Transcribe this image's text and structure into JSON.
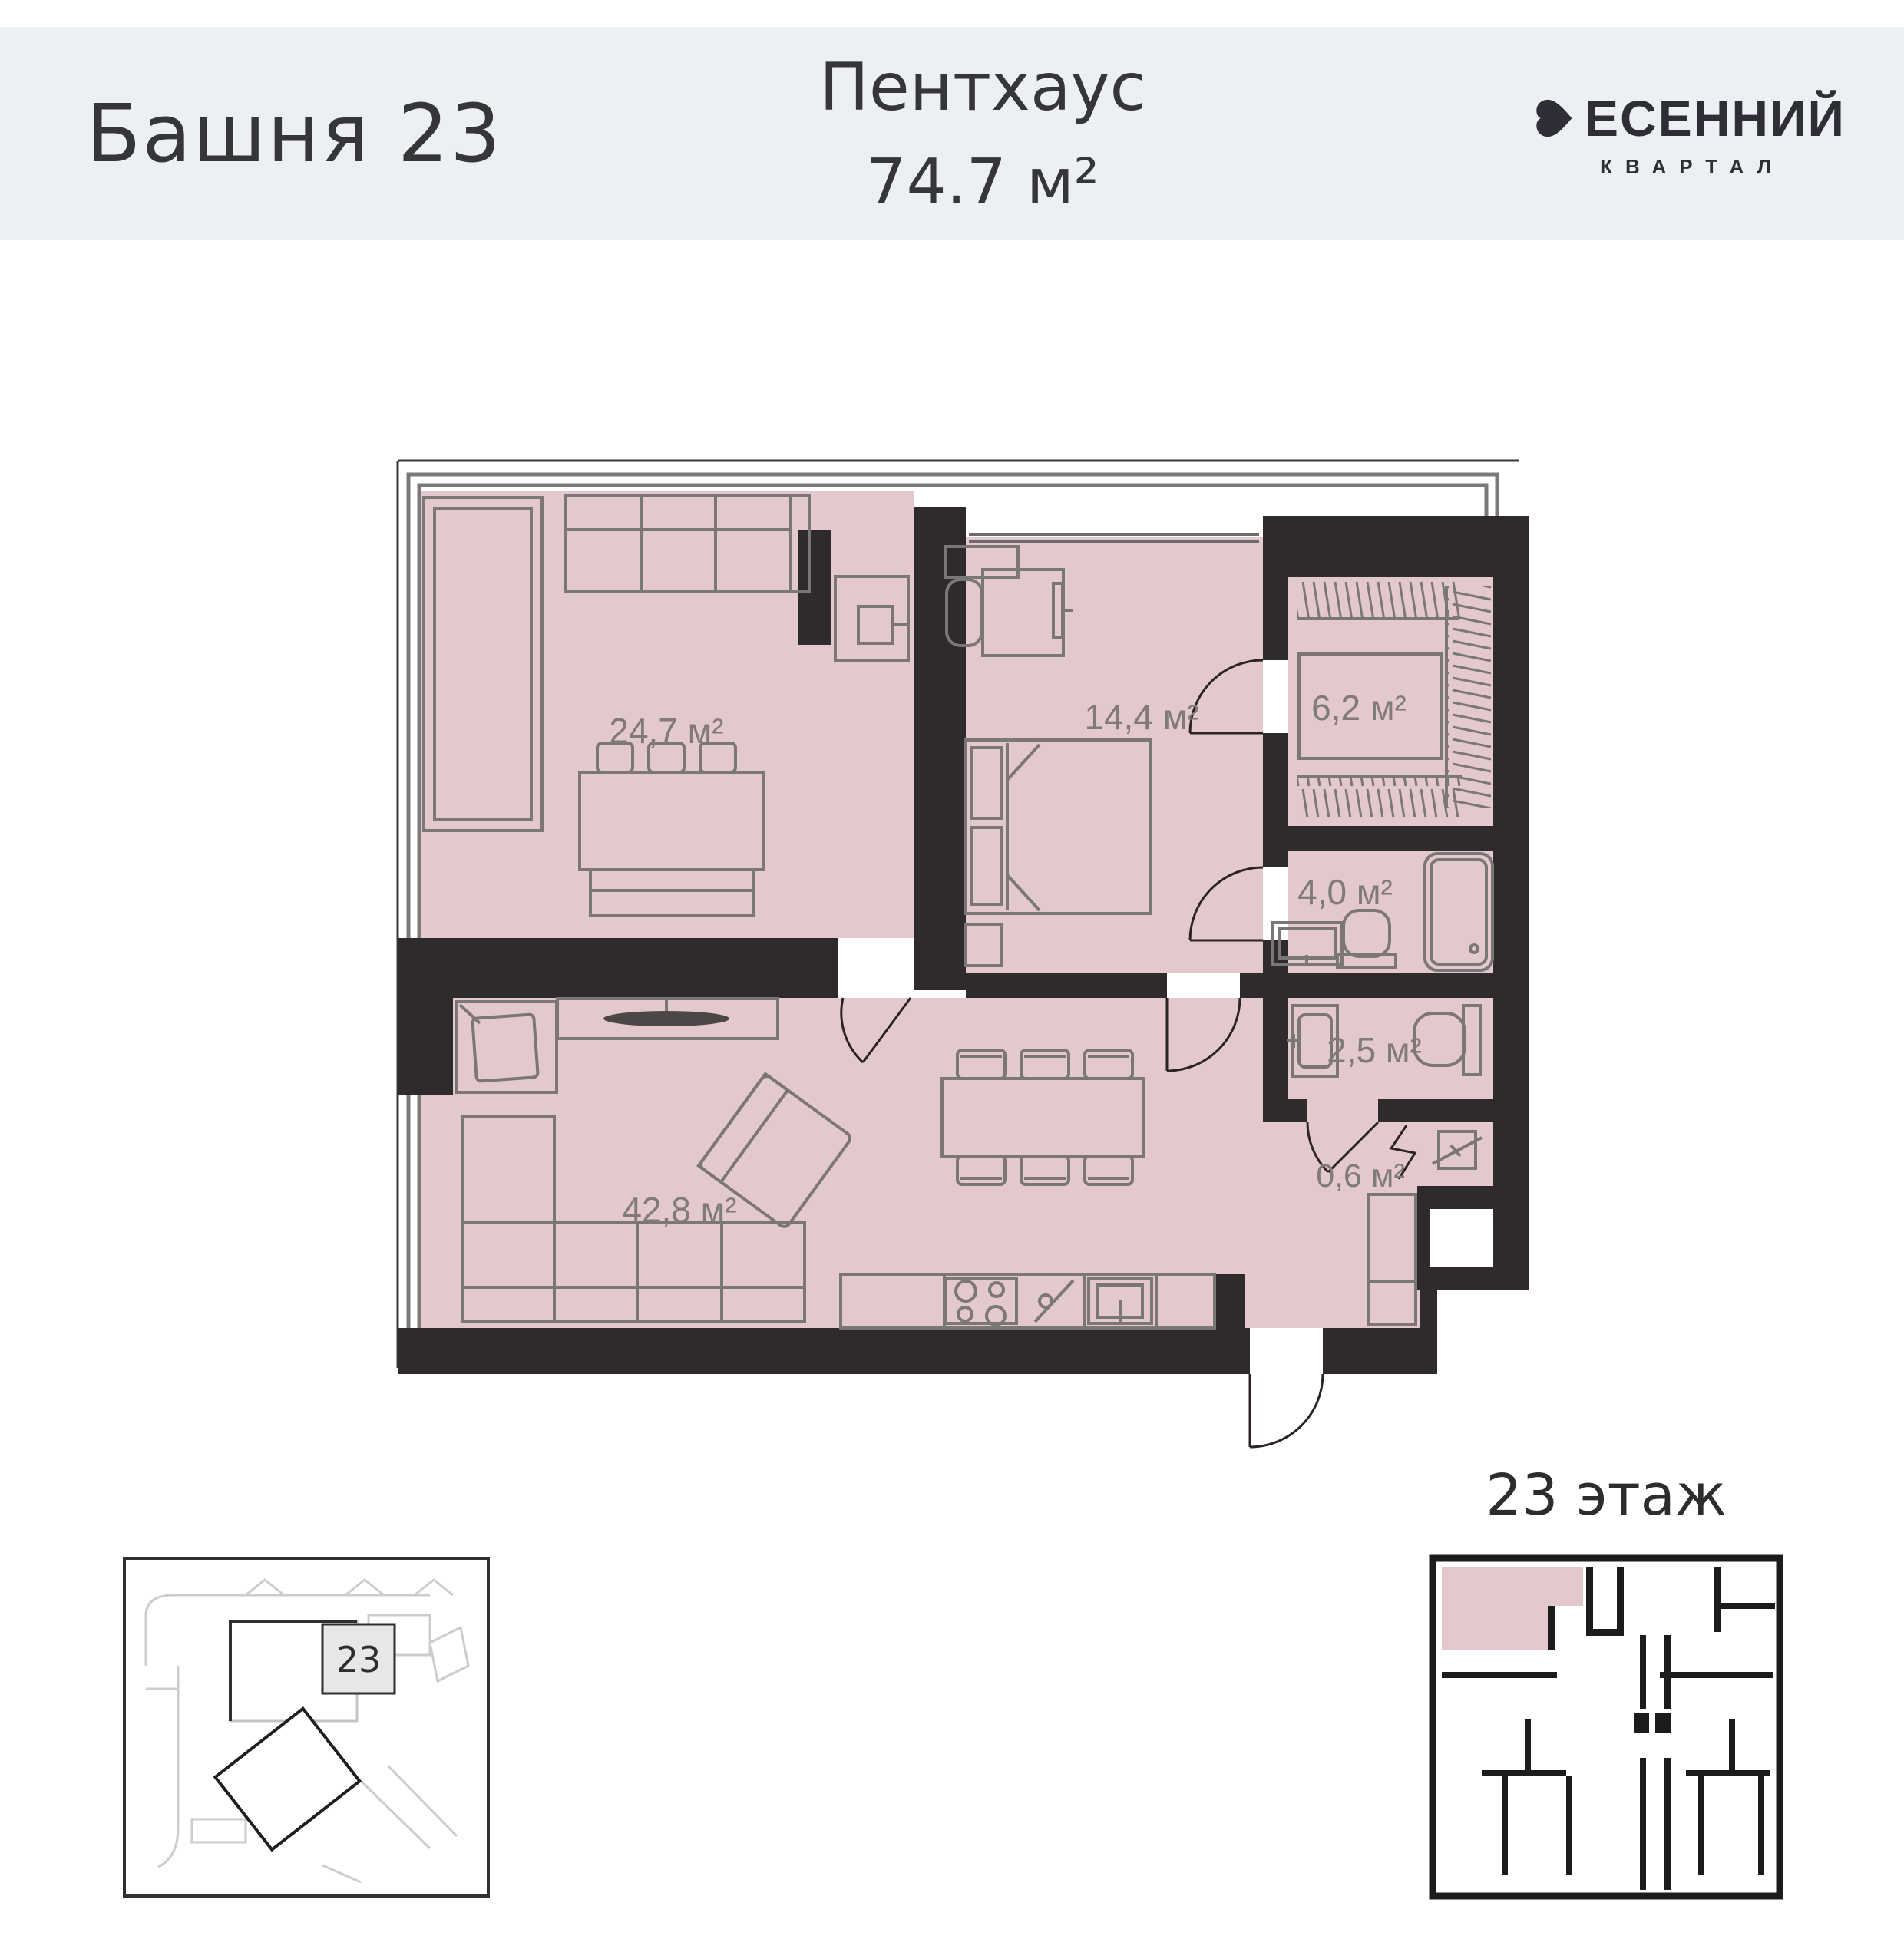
{
  "header": {
    "tower": "Башня 23",
    "unit_type": "Пентхаус",
    "unit_area": "74.7 м²",
    "brand": {
      "name": "ВЕСЕННИЙ",
      "name_rest": "ЕСЕННИЙ",
      "subtitle": "КВАРТАЛ"
    }
  },
  "plan": {
    "rooms": [
      {
        "name": "lounge",
        "area_label": "24,7 м²"
      },
      {
        "name": "bedroom",
        "area_label": "14,4 м²"
      },
      {
        "name": "wardrobe",
        "area_label": "6,2 м²"
      },
      {
        "name": "bathroom",
        "area_label": "4,0 м²"
      },
      {
        "name": "laundry-wc",
        "area_label": "2,5 м²"
      },
      {
        "name": "hall",
        "area_label": "0,6 м²"
      },
      {
        "name": "living-kitchen",
        "area_label": "42,8 м²"
      }
    ]
  },
  "floor_overview": {
    "title": "23 этаж"
  },
  "site_plan": {
    "tower_number": "23"
  },
  "colors": {
    "band": "#edf0f2",
    "apartment_fill": "#e3c8cd",
    "wall": "#2f2a2b",
    "furniture_line": "#7b7777",
    "label_text": "#807a7a"
  }
}
